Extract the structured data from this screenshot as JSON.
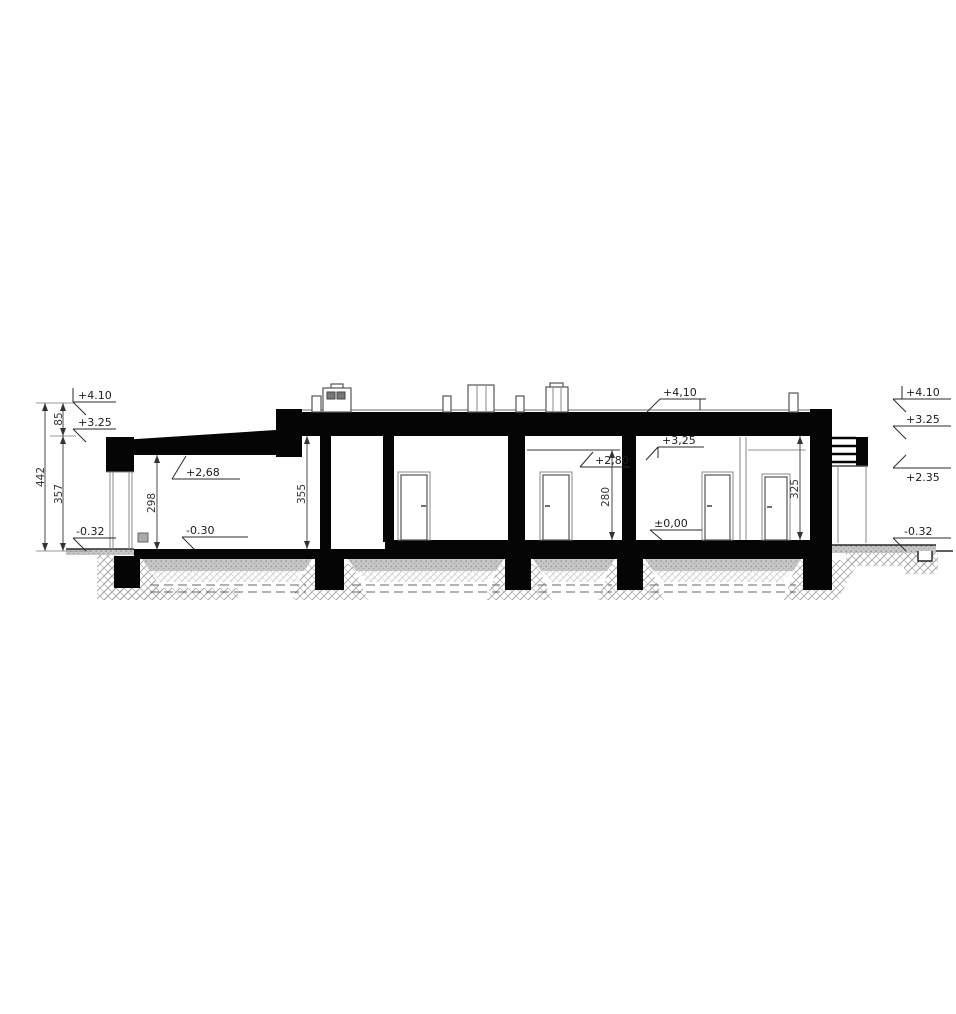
{
  "drawing": {
    "type": "building-cross-section",
    "ink_color": "#050505",
    "labels": {
      "left_410": "+4.10",
      "left_325": "+3.25",
      "left_032": "-0.32",
      "right_410": "+4.10",
      "right_325": "+3.25",
      "right_235": "+2.35",
      "right_032": "-0.32",
      "roof_410": "+4,10",
      "garage_ceiling": "+2,68",
      "garage_floor": "-0.30",
      "room4_ceiling": "+2,80",
      "room5_ceiling": "+3,25",
      "room5_floor": "±0,00"
    },
    "dimensions": {
      "total_height": "442",
      "parapet_height": "85",
      "wall_height": "357",
      "garage_clear_height": "298",
      "shaft_clear_height": "355",
      "room4_clear_height": "280",
      "room5_clear_height": "325"
    }
  }
}
